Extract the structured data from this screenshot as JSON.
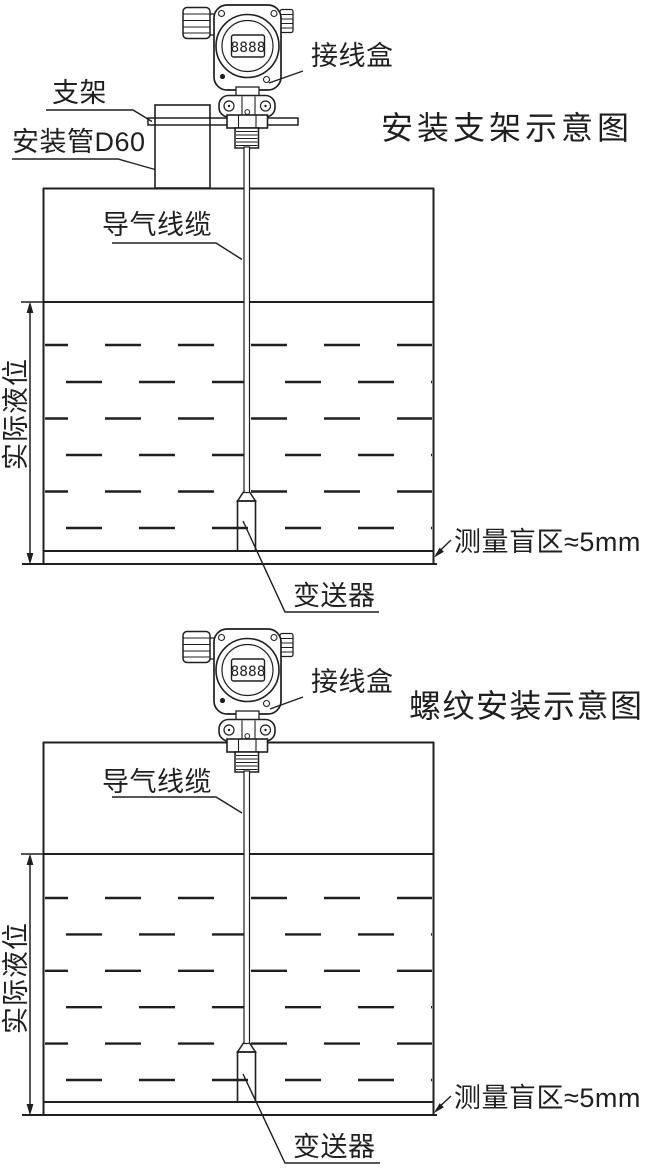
{
  "colors": {
    "line": "#1f1f1f",
    "background": "#ffffff"
  },
  "device": {
    "lcd_value": "8888"
  },
  "diagram1": {
    "title": "安装支架示意图",
    "junction_box_label": "接线盒",
    "bracket_label": "支架",
    "mounting_pipe_label": "安装管D60",
    "air_cable_label": "导气线缆",
    "actual_level_label": "实际液位",
    "transmitter_label": "变送器",
    "blind_zone_label": "测量盲区≈5mm"
  },
  "diagram2": {
    "title": "螺纹安装示意图",
    "junction_box_label": "接线盒",
    "air_cable_label": "导气线缆",
    "actual_level_label": "实际液位",
    "transmitter_label": "变送器",
    "blind_zone_label": "测量盲区≈5mm"
  }
}
